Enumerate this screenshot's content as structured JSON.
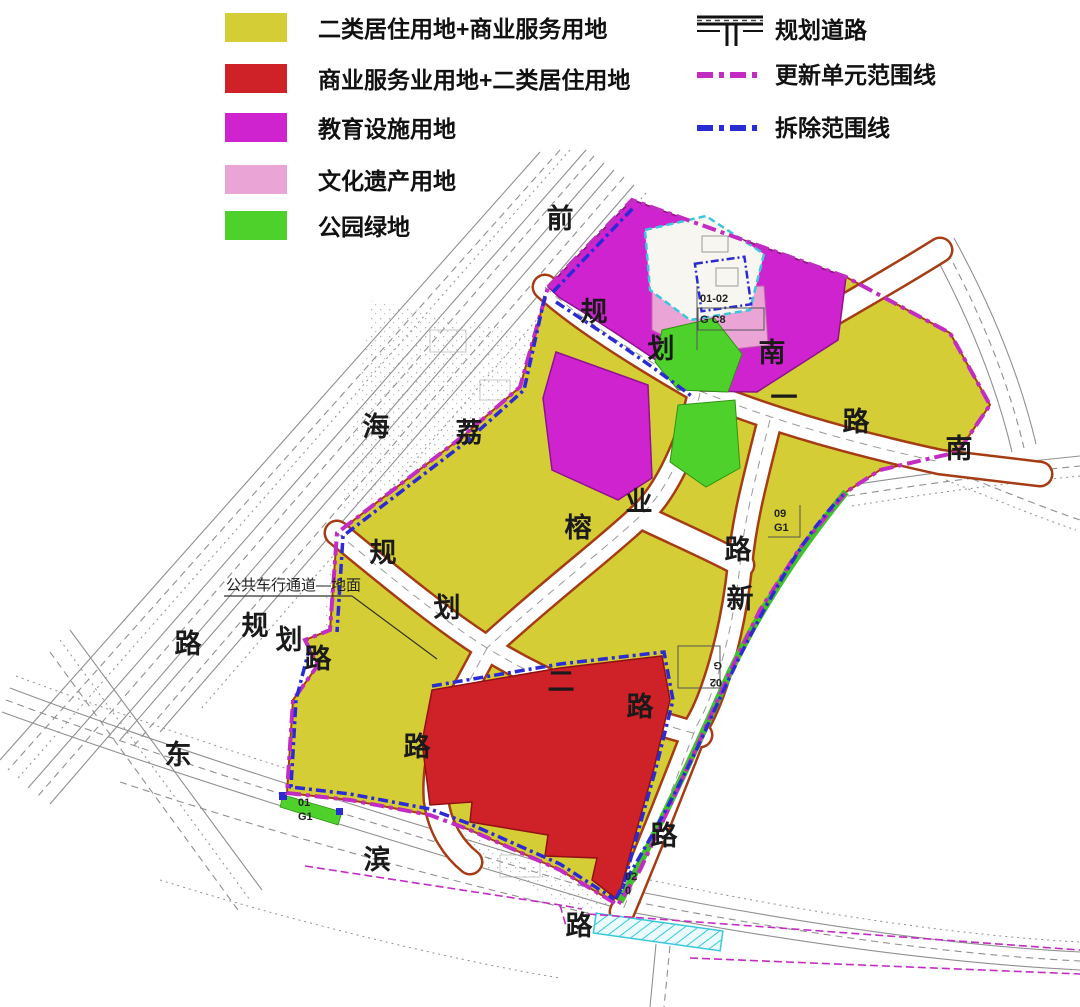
{
  "legend_left": {
    "items": [
      {
        "label": "二类居住用地+商业服务用地",
        "color": "#d4cd35"
      },
      {
        "label": "商业服务业用地+二类居住用地",
        "color": "#cf2128"
      },
      {
        "label": "教育设施用地",
        "color": "#d023d0"
      },
      {
        "label": "文化遗产用地",
        "color": "#eba4d6"
      },
      {
        "label": "公园绿地",
        "color": "#4ed12b"
      }
    ]
  },
  "legend_right": {
    "items": [
      {
        "label": "规划道路",
        "symbol": "road-icon"
      },
      {
        "label": "更新单元范围线",
        "symbol": "magenta-dashdot-line",
        "color": "#c22cc2"
      },
      {
        "label": "拆除范围线",
        "symbol": "blue-dashdot-line",
        "color": "#2b2bd5"
      }
    ]
  },
  "map": {
    "annotation": {
      "text": "公共车行通道—地面",
      "x": 226,
      "y": 590
    },
    "road_labels": [
      {
        "ch": "前",
        "x": 560,
        "y": 228
      },
      {
        "ch": "规",
        "x": 594,
        "y": 321
      },
      {
        "ch": "划",
        "x": 661,
        "y": 358
      },
      {
        "ch": "南",
        "x": 772,
        "y": 362
      },
      {
        "ch": "一",
        "x": 784,
        "y": 407
      },
      {
        "ch": "路",
        "x": 856,
        "y": 431
      },
      {
        "ch": "海",
        "x": 376,
        "y": 436
      },
      {
        "ch": "荔",
        "x": 469,
        "y": 442
      },
      {
        "ch": "南",
        "x": 959,
        "y": 458
      },
      {
        "ch": "业",
        "x": 639,
        "y": 511
      },
      {
        "ch": "榕",
        "x": 578,
        "y": 537
      },
      {
        "ch": "路",
        "x": 738,
        "y": 559
      },
      {
        "ch": "新",
        "x": 740,
        "y": 608
      },
      {
        "ch": "规",
        "x": 383,
        "y": 562
      },
      {
        "ch": "划",
        "x": 447,
        "y": 617
      },
      {
        "ch": "路",
        "x": 188,
        "y": 653
      },
      {
        "ch": "规",
        "x": 255,
        "y": 635
      },
      {
        "ch": "划",
        "x": 289,
        "y": 649
      },
      {
        "ch": "路",
        "x": 318,
        "y": 668
      },
      {
        "ch": "二",
        "x": 561,
        "y": 691
      },
      {
        "ch": "路",
        "x": 640,
        "y": 716
      },
      {
        "ch": "东",
        "x": 178,
        "y": 764
      },
      {
        "ch": "路",
        "x": 417,
        "y": 756
      },
      {
        "ch": "滨",
        "x": 377,
        "y": 869
      },
      {
        "ch": "路",
        "x": 664,
        "y": 845
      },
      {
        "ch": "路",
        "x": 579,
        "y": 935
      }
    ],
    "parcel_codes": [
      {
        "lines": [
          "01-02",
          "G C8"
        ],
        "x": 700,
        "y": 302,
        "dy": 21,
        "rotate": 0
      },
      {
        "lines": [
          "09",
          "G1"
        ],
        "x": 774,
        "y": 517,
        "dy": 14,
        "rotate": 0
      },
      {
        "lines": [
          "02",
          "G"
        ],
        "x": 702,
        "y": 662,
        "dy": 17,
        "rotate": 180
      },
      {
        "lines": [
          "01",
          "G1"
        ],
        "x": 298,
        "y": 806,
        "dy": 14,
        "rotate": 0
      },
      {
        "lines": [
          "02",
          "0"
        ],
        "x": 625,
        "y": 880,
        "dy": 14,
        "rotate": 0
      }
    ],
    "colors": {
      "residential_commercial": "#d4cd35",
      "commercial_residential": "#cf2128",
      "education": "#d023d0",
      "heritage": "#eba4d6",
      "park_green": "#4ed12b",
      "unit_boundary": "#c22cc2",
      "demolition_boundary": "#2b2bd5",
      "parcel_outline": "#a63c14",
      "cyan_plot": "#39c7dc"
    }
  }
}
